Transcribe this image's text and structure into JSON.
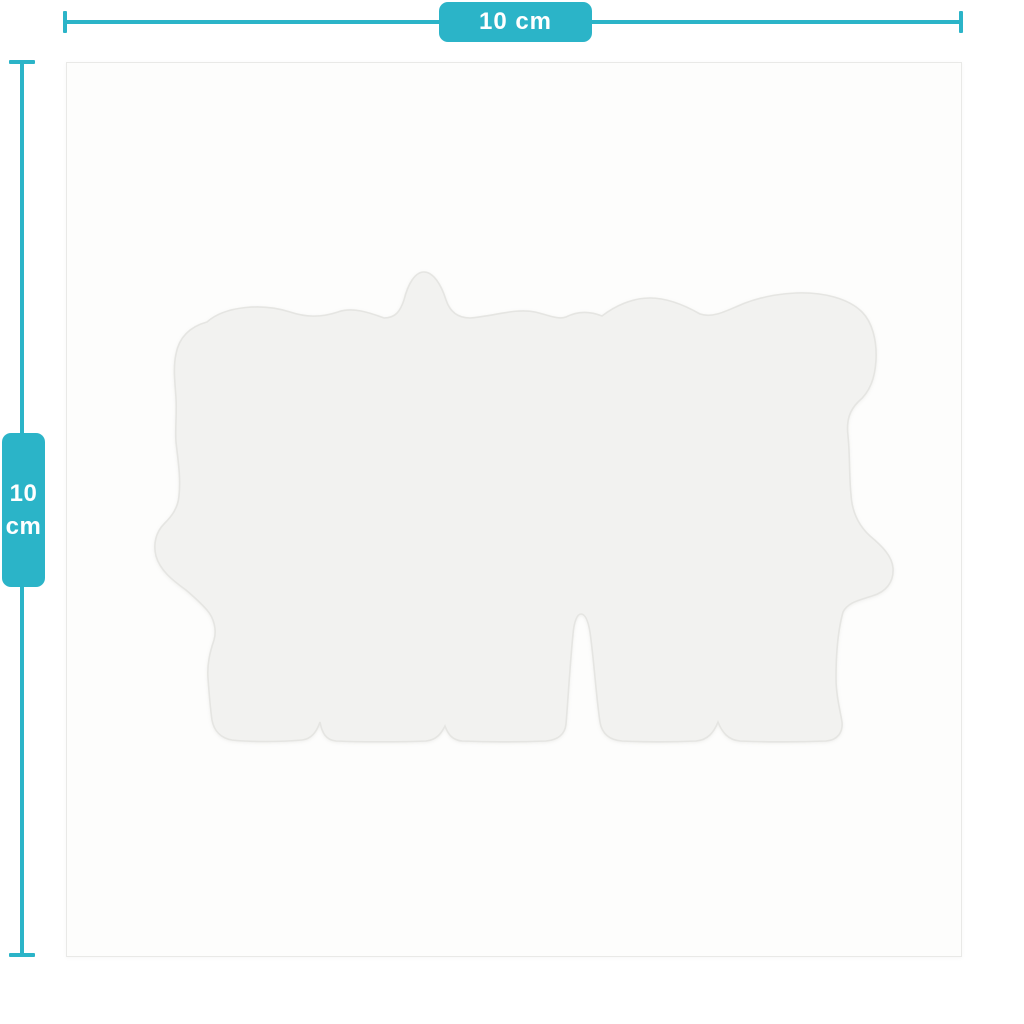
{
  "rulers": {
    "horizontal": {
      "label": "10 cm"
    },
    "vertical": {
      "value": "10",
      "unit": "cm"
    }
  },
  "colors": {
    "accent": "#2bb4c8",
    "label_text": "#ffffff",
    "sheet_background": "#fdfdfc",
    "sheet_border": "#e9e9e7",
    "sticker_fill": "#f2f2f0",
    "sticker_edge": "#e5e5e2"
  }
}
